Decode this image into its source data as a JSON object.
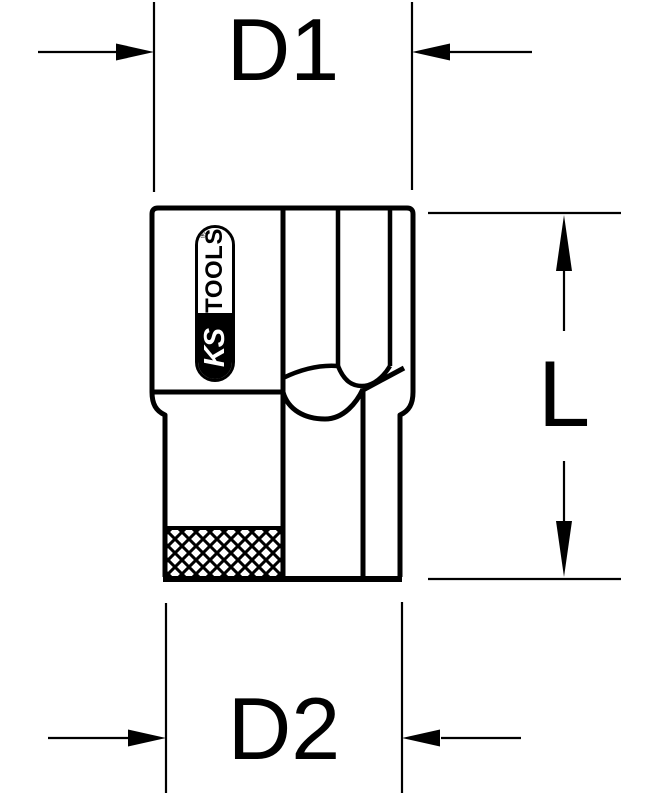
{
  "drawing": {
    "kind": "technical-dimension-drawing",
    "labels": {
      "d1": "D1",
      "d2": "D2",
      "length": "L"
    },
    "logo": {
      "ks": "KS",
      "tools": "TOOLS",
      "registered": "®"
    },
    "colors": {
      "line": "#000000",
      "background": "#ffffff"
    }
  }
}
